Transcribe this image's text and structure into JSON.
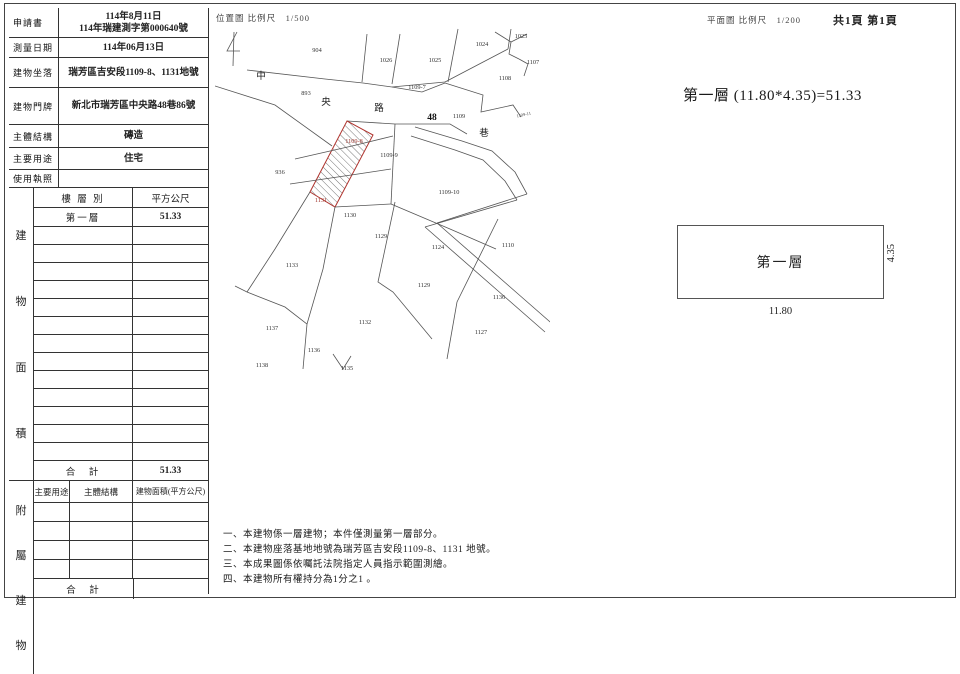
{
  "sheet": {
    "location_map_label": "位置圖 比例尺　1/500",
    "floor_plan_label": "平面圖 比例尺　1/200",
    "page_info": "共1頁 第1頁",
    "formula": "第一層 (11.80*4.35)=51.33"
  },
  "info_table": {
    "rows": [
      {
        "label": "申請書",
        "line1": "114年8月11日",
        "line2": "114年瑞建測字第000640號"
      },
      {
        "label": "測量日期",
        "line1": "114年06月13日",
        "line2": ""
      },
      {
        "label": "建物坐落",
        "line1": "瑞芳區吉安段1109-8、1131地號",
        "line2": ""
      },
      {
        "label": "建物門牌",
        "line1": "新北市瑞芳區中央路48巷86號",
        "line2": ""
      },
      {
        "label": "主體結構",
        "line1": "磚造",
        "line2": ""
      },
      {
        "label": "主要用途",
        "line1": "住宅",
        "line2": ""
      },
      {
        "label": "使用執照",
        "line1": "",
        "line2": ""
      }
    ]
  },
  "area_table": {
    "side_chars": [
      "建",
      "物",
      "面",
      "積"
    ],
    "header": {
      "floor": "樓 層 別",
      "area": "平方公尺"
    },
    "first_row": {
      "floor": "第一層",
      "area": "51.33"
    },
    "total_label": "合　計",
    "total_value": "51.33"
  },
  "annex_table": {
    "side_chars": [
      "附",
      "屬",
      "建",
      "物"
    ],
    "headers": [
      "主要用途",
      "主體結構",
      "建物面積(平方公尺)"
    ],
    "total_label": "合　計",
    "total_value": ""
  },
  "floor_plan": {
    "room_label": "第一層",
    "width_dim": "11.80",
    "height_dim": "4.35"
  },
  "notes": [
    "一、本建物係一層建物；本件僅測量第一層部分。",
    "二、本建物座落基地地號為瑞芳區吉安段1109-8、1131 地號。",
    "三、本成果圖係依囑託法院指定人員指示範圍測繪。",
    "四、本建物所有權持分為1分之1 。"
  ],
  "map": {
    "subject_parcels": [
      "1109-8",
      "1131"
    ],
    "labels": [
      {
        "t": "904",
        "x": 102,
        "y": 28,
        "cls": "pn"
      },
      {
        "t": "1026",
        "x": 171,
        "y": 38,
        "cls": "pn"
      },
      {
        "t": "1025",
        "x": 220,
        "y": 38,
        "cls": "pn"
      },
      {
        "t": "1024",
        "x": 267,
        "y": 22,
        "cls": "pn"
      },
      {
        "t": "1023",
        "x": 306,
        "y": 14,
        "cls": "pn"
      },
      {
        "t": "1107",
        "x": 318,
        "y": 40,
        "cls": "pn"
      },
      {
        "t": "1108",
        "x": 290,
        "y": 56,
        "cls": "pn"
      },
      {
        "t": "1109-7",
        "x": 202,
        "y": 65,
        "cls": "pn"
      },
      {
        "t": "893",
        "x": 91,
        "y": 71,
        "cls": "pn"
      },
      {
        "t": "中",
        "x": 46,
        "y": 55,
        "cls": "cn"
      },
      {
        "t": "央",
        "x": 111,
        "y": 81,
        "cls": "cn"
      },
      {
        "t": "路",
        "x": 164,
        "y": 87,
        "cls": "cn"
      },
      {
        "t": "48",
        "x": 217,
        "y": 96,
        "cls": "bld"
      },
      {
        "t": "1109",
        "x": 244,
        "y": 94,
        "cls": "pn"
      },
      {
        "t": "巷",
        "x": 269,
        "y": 112,
        "cls": "cn"
      },
      {
        "t": "1109-11",
        "x": 309,
        "y": 92,
        "cls": "tiny",
        "rot": -12
      },
      {
        "t": "936",
        "x": 65,
        "y": 150,
        "cls": "pn"
      },
      {
        "t": "1109-8",
        "x": 139,
        "y": 119,
        "cls": "pn rd"
      },
      {
        "t": "1109-9",
        "x": 174,
        "y": 133,
        "cls": "pn"
      },
      {
        "t": "1131",
        "x": 106,
        "y": 178,
        "cls": "pn rd"
      },
      {
        "t": "1109-10",
        "x": 234,
        "y": 170,
        "cls": "pn"
      },
      {
        "t": "1130",
        "x": 135,
        "y": 193,
        "cls": "pn"
      },
      {
        "t": "1129",
        "x": 166,
        "y": 214,
        "cls": "pn"
      },
      {
        "t": "1124",
        "x": 223,
        "y": 225,
        "cls": "pn"
      },
      {
        "t": "1110",
        "x": 293,
        "y": 223,
        "cls": "pn"
      },
      {
        "t": "1133",
        "x": 77,
        "y": 243,
        "cls": "pn"
      },
      {
        "t": "1129",
        "x": 209,
        "y": 263,
        "cls": "pn"
      },
      {
        "t": "1136",
        "x": 284,
        "y": 275,
        "cls": "pn"
      },
      {
        "t": "1132",
        "x": 150,
        "y": 300,
        "cls": "pn"
      },
      {
        "t": "1137",
        "x": 57,
        "y": 306,
        "cls": "pn"
      },
      {
        "t": "1127",
        "x": 266,
        "y": 310,
        "cls": "pn"
      },
      {
        "t": "1136",
        "x": 99,
        "y": 328,
        "cls": "pn"
      },
      {
        "t": "1138",
        "x": 47,
        "y": 343,
        "cls": "pn"
      },
      {
        "t": "1135",
        "x": 132,
        "y": 346,
        "cls": "pn"
      }
    ]
  }
}
